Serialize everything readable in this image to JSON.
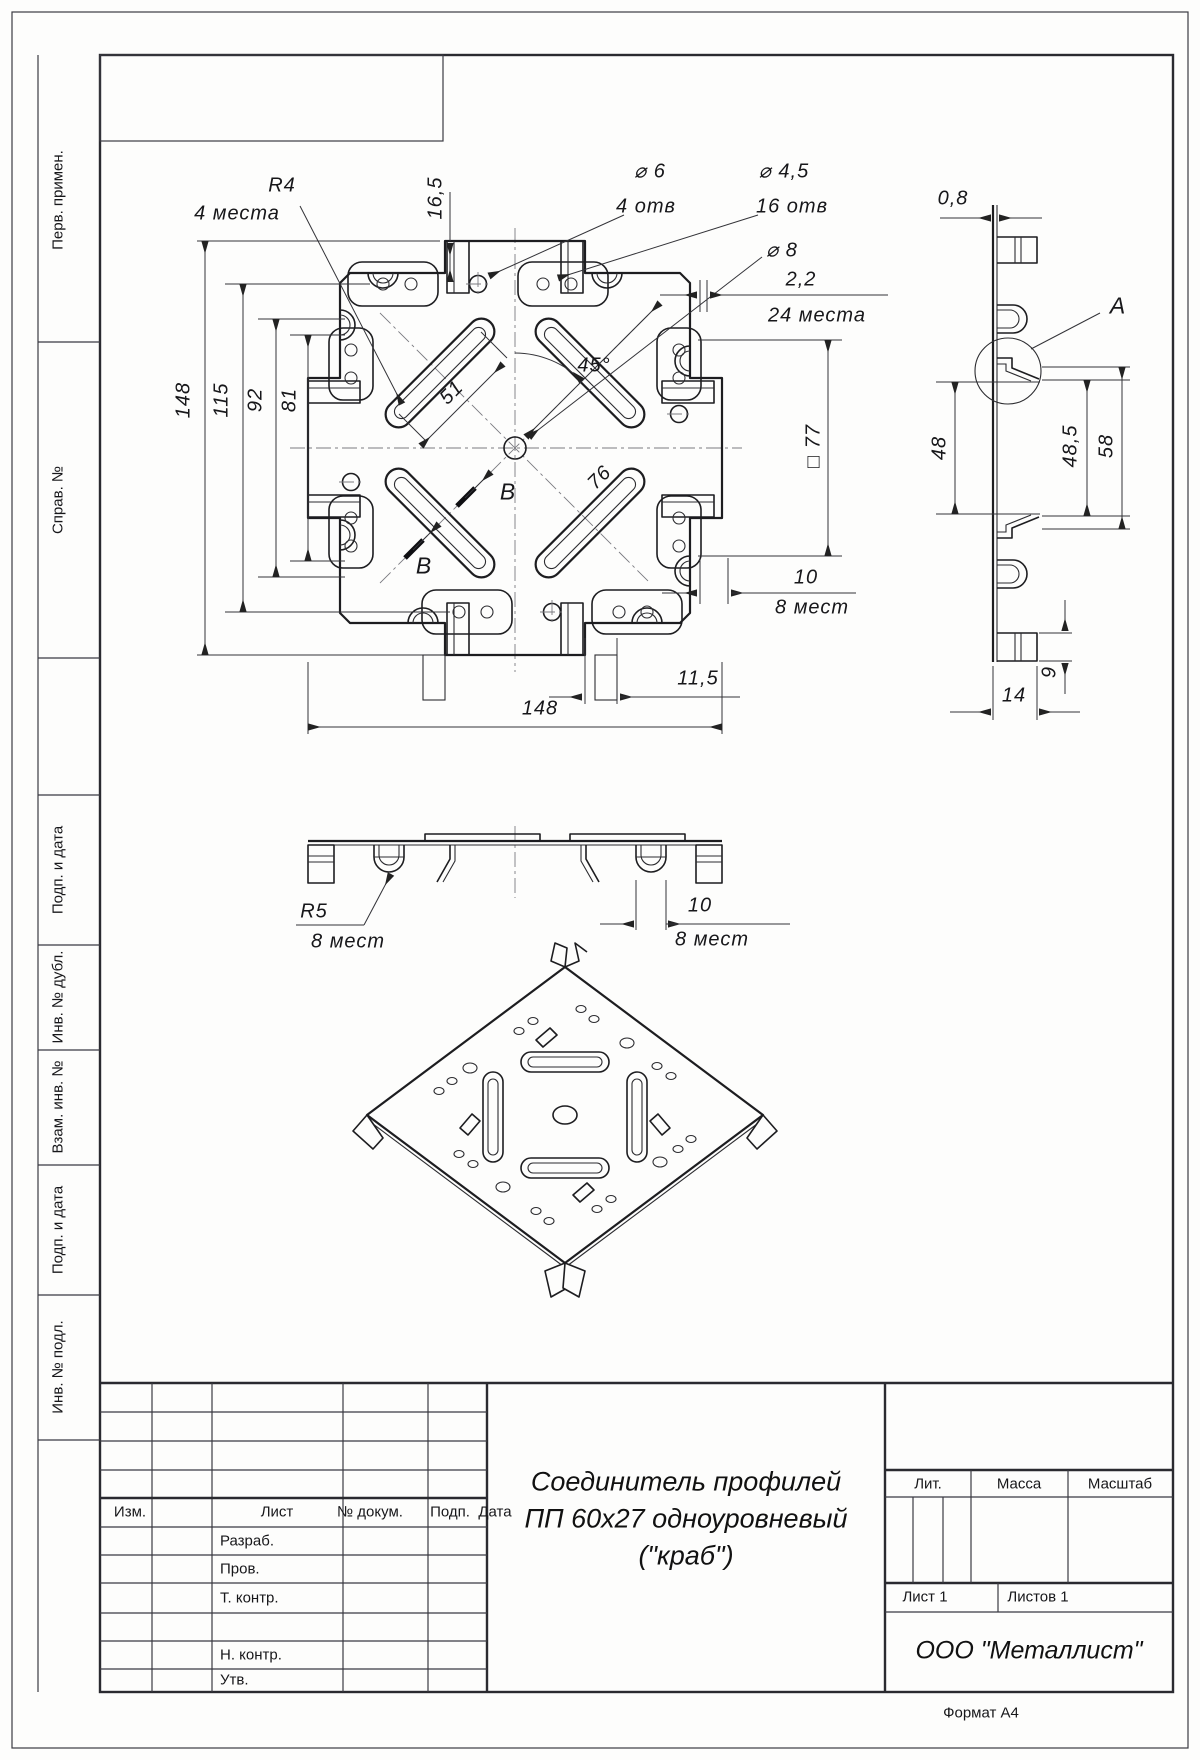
{
  "page": {
    "format": "Формат А4"
  },
  "left_strip": {
    "items": [
      "Перв. примен.",
      "Справ. №",
      "Подп. и дата",
      "Инв. № дубл.",
      "Взам. инв. №",
      "Подп. и дата",
      "Инв. № подл."
    ]
  },
  "views": {
    "top": {
      "dims": {
        "r4": "R4",
        "r4_note": "4 места",
        "d165": "16,5",
        "d6": "⌀ 6",
        "d6_note": "4 отв",
        "d45": "⌀ 4,5",
        "d45_note": "16 отв",
        "d8": "⌀ 8",
        "d22": "2,2",
        "places24": "24 места",
        "v148": "148",
        "v115": "115",
        "v92": "92",
        "v81": "81",
        "len51": "51",
        "ang45": "45°",
        "diag76": "76",
        "sq77": "□ 77",
        "t10": "10",
        "t10_note": "8 мест",
        "d115": "11,5",
        "h148": "148",
        "secB": "В"
      }
    },
    "side": {
      "dims": {
        "t08": "0,8",
        "detail_a": "А",
        "v48": "48",
        "v485": "48,5",
        "v58": "58",
        "h14": "14",
        "v9": "9"
      }
    },
    "front": {
      "dims": {
        "r5": "R5",
        "r5_note": "8 мест",
        "w10": "10",
        "w10_note": "8 мест"
      }
    }
  },
  "title_block": {
    "cols": {
      "izm": "Изм.",
      "list": "Лист",
      "doc": "№ докум.",
      "podp": "Подп.",
      "data": "Дата"
    },
    "rows": {
      "razrab": "Разраб.",
      "prov": "Пров.",
      "tkontr": "Т. контр.",
      "nkontr": "Н. контр.",
      "utv": "Утв."
    },
    "lit": "Лит.",
    "massa": "Масса",
    "masshtab": "Масштаб",
    "list1": "Лист 1",
    "listov1": "Листов 1",
    "company": "ООО \"Металлист\"",
    "title_line1": "Соединитель профилей",
    "title_line2": "ПП 60х27 одноуровневый",
    "title_line3": "(\"краб\")"
  }
}
